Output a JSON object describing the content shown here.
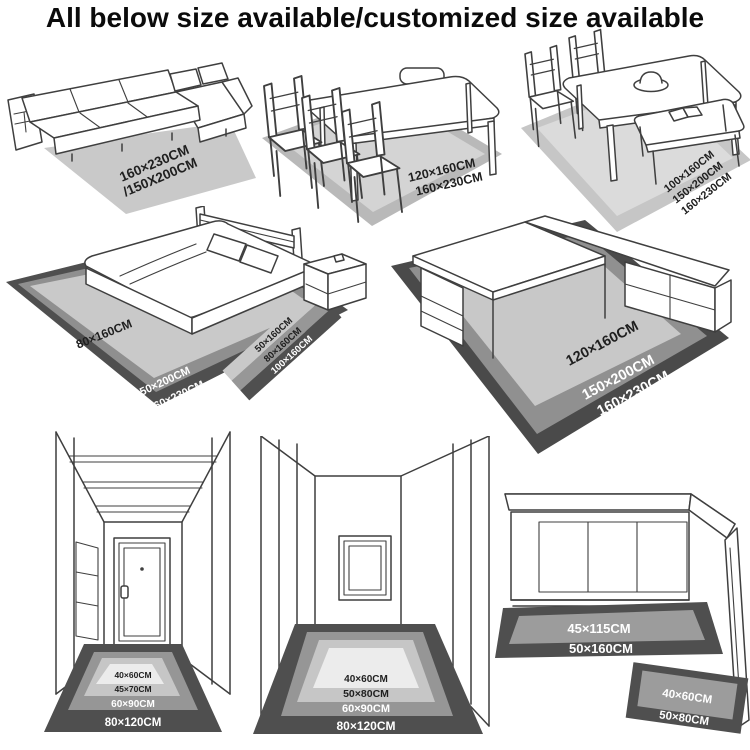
{
  "title": "All below size available/customized size available",
  "colors": {
    "line_art": "#3f3f3f",
    "mat_white": "#ececec",
    "mat_light": "#c8c8c8",
    "mat_medium": "#969696",
    "mat_dark": "#4f4f4f",
    "label_dark": "#1f1f1f",
    "label_light": "#ffffff"
  },
  "scenes": {
    "sofa": {
      "name": "living room sectional sofa rug",
      "label_line1": "160×230CM",
      "label_line2": "/150X200CM"
    },
    "dining_table": {
      "name": "dining table with chairs rug",
      "labels": [
        "120×160CM",
        "160×230CM"
      ]
    },
    "dining_bench": {
      "name": "dining table with bench rug",
      "labels": [
        "100×160CM",
        "150×200CM",
        "160×230CM"
      ]
    },
    "bedroom": {
      "name": "bedroom rug and bedside runner",
      "rug_label": "80×160CM",
      "edge_labels": [
        "150×200CM",
        "160×230CM"
      ],
      "runner_labels": [
        "50×160CM",
        "80×160CM",
        "100×160CM"
      ]
    },
    "desk": {
      "name": "L-shaped desk rug",
      "labels": [
        "120×160CM",
        "150×200CM",
        "160×230CM"
      ]
    },
    "hallway_door": {
      "name": "hallway with door mats",
      "labels": [
        "40×60CM",
        "45×70CM",
        "60×90CM",
        "80×120CM"
      ]
    },
    "hallway_window": {
      "name": "hallway with window mats",
      "labels": [
        "40×60CM",
        "50×80CM",
        "60×90CM",
        "80×120CM"
      ]
    },
    "kitchen": {
      "name": "kitchen counter mats",
      "runner_labels": [
        "45×115CM",
        "50×160CM"
      ],
      "corner_mat_labels": [
        "40×60CM",
        "50×80CM"
      ]
    }
  }
}
